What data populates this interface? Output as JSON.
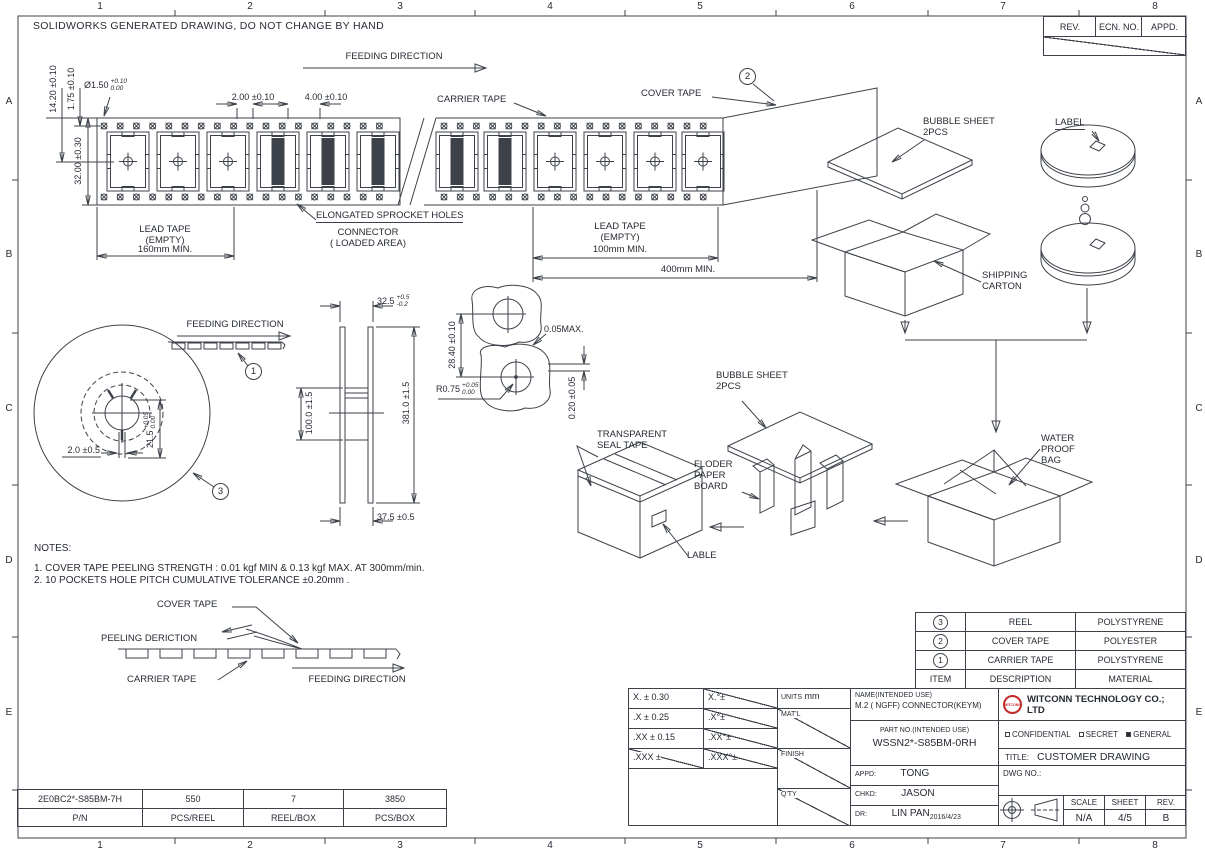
{
  "sheet": {
    "solidworks_note": "SOLIDWORKS GENERATED DRAWING, DO NOT CHANGE BY HAND",
    "grid_cols": [
      "1",
      "2",
      "3",
      "4",
      "5",
      "6",
      "7",
      "8"
    ],
    "grid_rows": [
      "A",
      "B",
      "C",
      "D",
      "E"
    ],
    "rev_table": {
      "rev": "REV.",
      "ecn": "ECN. NO.",
      "appd": "APPD."
    }
  },
  "tape_view": {
    "feeding_direction": "FEEDING DIRECTION",
    "carrier_tape": "CARRIER TAPE",
    "cover_tape": "COVER TAPE",
    "balloon_cover_tape": "2",
    "elongated": "ELONGATED SPROCKET HOLES",
    "lead_tape_left": "LEAD TAPE\n(EMPTY)",
    "lead_left_min": "160mm MIN.",
    "connector_area": "CONNECTOR\n( LOADED AREA)",
    "lead_tape_right": "LEAD TAPE\n(EMPTY)",
    "lead_right_min": "100mm MIN.",
    "total_min": "400mm MIN.",
    "dim_width": "32.00 ±0.30",
    "dim_pocket_center": "14.20 ±0.10",
    "dim_hole_edge": "1.75 ±0.10",
    "dim_hole_dia": {
      "main": "Ø1.50",
      "upper": "+0.10",
      "lower": "0.00"
    },
    "dim_hole_pitch": "2.00 ±0.10",
    "dim_pocket_pitch": "4.00 ±0.10"
  },
  "packing_top": {
    "bubble_sheet": "BUBBLE SHEET\n2PCS",
    "label": "LABEL",
    "shipping_carton": "SHIPPING\nCARTON"
  },
  "reel_front": {
    "feeding_direction": "FEEDING DIRECTION",
    "balloon_tape": "1",
    "balloon_reel": "3",
    "dim_slot": "2.0 ±0.5",
    "dim_hub": {
      "main": "21.5",
      "upper": "+0.05",
      "lower": "0.00"
    }
  },
  "reel_side": {
    "dim_flange_gap": {
      "main": "32.5",
      "upper": "+0.5",
      "lower": "-0.2"
    },
    "dim_diameter": "381.0 ±1.5",
    "dim_width": "37.5 ±0.5",
    "dim_hub_dia": "100.0 ±1.5"
  },
  "pocket_detail": {
    "dim_hole_span": "28.40 ±0.10",
    "dim_gap": "0.05MAX.",
    "dim_radius": {
      "main": "R0.75",
      "upper": "+0.05",
      "lower": "0.00"
    },
    "dim_standoff": "0.20 ±0.05"
  },
  "packing_mid": {
    "bubble_sheet": "BUBBLE SHEET\n2PCS",
    "transparent_seal_tape": "TRANSPARENT\nSEAL TAPE",
    "floder_paper_board": "FLODER\nPAPER\nBOARD",
    "lable": "LABLE",
    "water_proof_bag": "WATER\nPROOF\nBAG"
  },
  "notes": {
    "title": "NOTES:",
    "items": [
      "1. COVER TAPE PEELING STRENGTH : 0.01 kgf MIN & 0.13 kgf MAX. AT 300mm/min.",
      "2. 10 POCKETS HOLE PITCH CUMULATIVE TOLERANCE ±0.20mm ."
    ]
  },
  "peel_view": {
    "cover_tape": "COVER TAPE",
    "peeling_direction": "PEELING DERICTION",
    "carrier_tape": "CARRIER TAPE",
    "feeding_direction": "FEEDING DIRECTION"
  },
  "material_table": {
    "rows": [
      {
        "item": "3",
        "description": "REEL",
        "material": "POLYSTYRENE"
      },
      {
        "item": "2",
        "description": "COVER TAPE",
        "material": "POLYESTER"
      },
      {
        "item": "1",
        "description": "CARRIER TAPE",
        "material": "POLYSTYRENE"
      }
    ],
    "header": {
      "item": "ITEM",
      "description": "DESCRIPTION",
      "material": "MATERIAL"
    }
  },
  "tolerance_table": {
    "rows": [
      {
        "lin": "X. ±",
        "lin_val": "0.30",
        "ang": "X.°±"
      },
      {
        "lin": ".X ±",
        "lin_val": "0.25",
        "ang": ".X°±"
      },
      {
        "lin": ".XX ±",
        "lin_val": "0.15",
        "ang": ".XX°±"
      },
      {
        "lin": ".XXX ±",
        "lin_val": "",
        "ang": ".XXX°±"
      }
    ],
    "units_label": "UNITS",
    "units_value": "mm",
    "matl": "MAT'L",
    "finish": "FINISH",
    "qty": "Q'TY"
  },
  "title_block": {
    "name_label": "NAME(INTENDED USE)",
    "name_value": "M.2 ( NGFF) CONNECTOR(KEYM)",
    "logo": "WITCONN",
    "company": "WITCONN TECHNOLOGY CO.; LTD",
    "part_label": "PART NO.(INTENDED USE)",
    "part_value": "WSSN2*-S85BM-0RH",
    "confidential": "CONFIDENTIAL",
    "secret": "SECRET",
    "general": "GENERAL",
    "title_label": "TITLE:",
    "title_value": "CUSTOMER DRAWING",
    "dwg_label": "DWG NO.:",
    "appd_label": "APPD:",
    "appd_value": "TONG",
    "chkd_label": "CHKD:",
    "chkd_value": "JASON",
    "dr_label": "DR:",
    "dr_value": "LIN PAN",
    "dr_date": "2016/4/23",
    "scale_label": "SCALE",
    "scale_value": "N/A",
    "sheet_label": "SHEET",
    "sheet_value": "4/5",
    "rev_label": "REV.",
    "rev_value": "B"
  },
  "pn_table": {
    "values": [
      "2E0BC2*-S85BM-7H",
      "550",
      "7",
      "3850"
    ],
    "labels": [
      "P/N",
      "PCS/REEL",
      "REEL/BOX",
      "PCS/BOX"
    ]
  }
}
